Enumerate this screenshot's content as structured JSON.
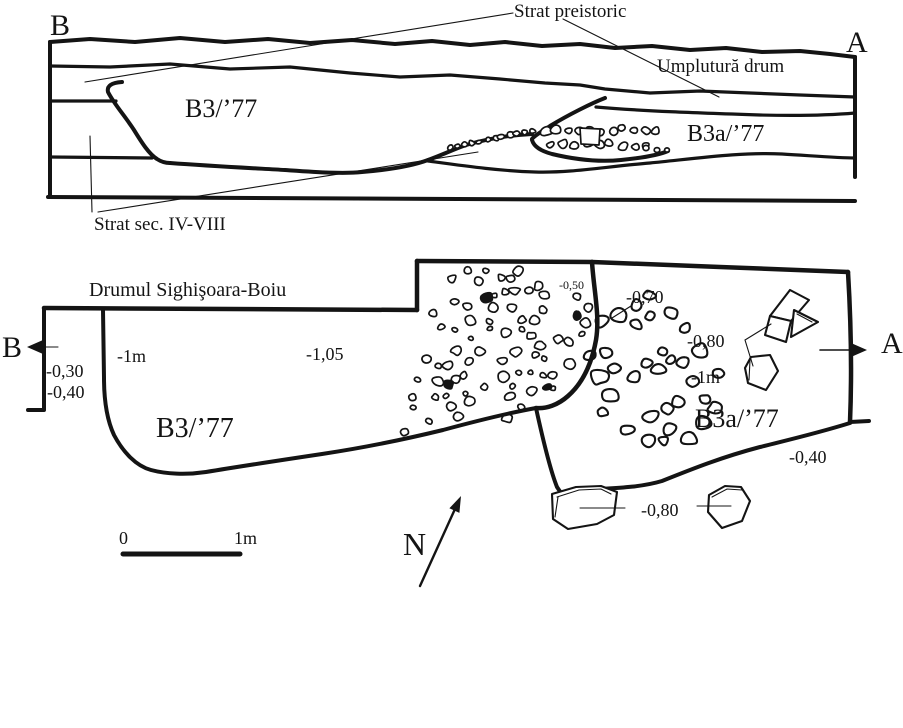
{
  "diagram": {
    "ink_color": "#141414",
    "background_color": "#ffffff"
  },
  "section_view": {
    "end_label_left": "B",
    "end_label_right": "A",
    "layer_label_prehistoric": "Strat preistoric",
    "layer_label_road_fill": "Umplutură drum",
    "layer_label_4th_8th_century": "Strat sec. IV-VIII",
    "trench_label_b3": "B3/’77",
    "trench_label_b3a": "B3a/’77"
  },
  "plan_view": {
    "road_label": "Drumul Sighişoara-Boiu",
    "end_label_left": "B",
    "end_label_right": "A",
    "trench_label_b3": "B3/’77",
    "trench_label_b3a": "B3a/’77",
    "depth_labels": {
      "baulk_upper": "-0,30",
      "baulk_lower": "-0,40",
      "b3_west": "-1m",
      "b3_center": "-1,05",
      "divider_top": "-0,50",
      "b3a_upper": "-0,70",
      "b3a_stones": "-0,80",
      "b3a_center": "-1m",
      "b3a_southeast": "-0,40",
      "south_stones": "-0,80"
    }
  },
  "scale_bar": {
    "zero_label": "0",
    "one_meter_label": "1m"
  },
  "north_arrow": {
    "label": "N"
  }
}
